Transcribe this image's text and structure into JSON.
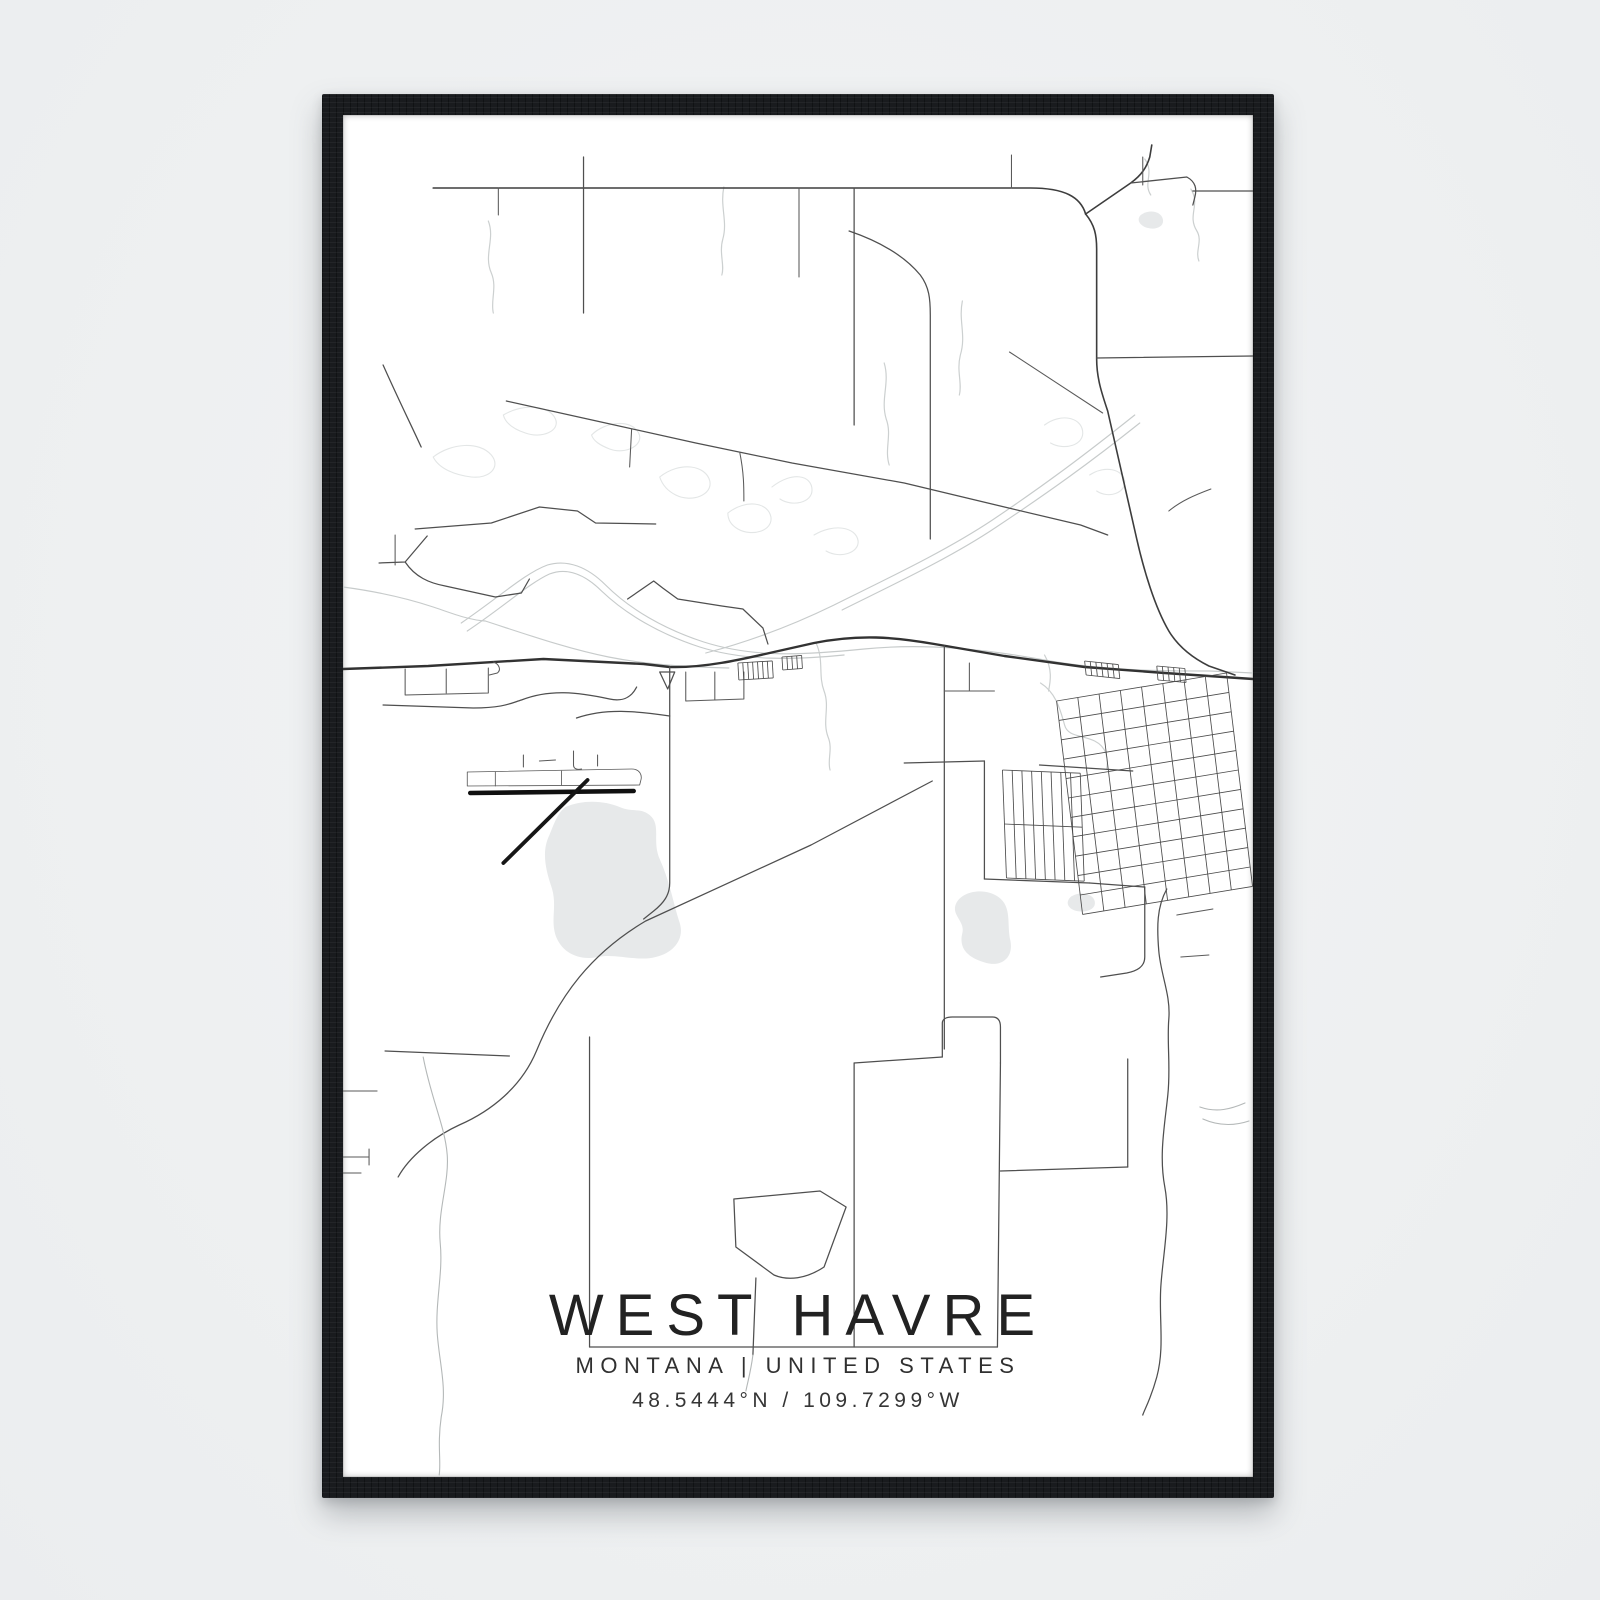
{
  "poster": {
    "title": "WEST HAVRE",
    "subtitle": "MONTANA | UNITED STATES",
    "coordinates": "48.5444°N / 109.7299°W"
  },
  "frame": {
    "color": "#191b1e",
    "background": "#eef0f1",
    "poster_color": "#ffffff"
  },
  "map": {
    "viewbox": "0 0 908 1362",
    "colors": {
      "road": "#4f4f4f",
      "major_road": "#323232",
      "highway": "#3d3d3d",
      "stream": "#ccd0d0",
      "meander": "#e3e6e6",
      "railway": "#c7cbcb",
      "water": "#e7e9ea",
      "runway": "#101010"
    },
    "features": [
      {
        "name": "lake-big",
        "type": "water",
        "d": "M 222,692 C 240,684 262,686 276,692 C 290,698 296,692 306,700 C 318,710 308,726 316,744 C 326,766 330,790 336,808 C 341,824 330,838 312,842 C 294,847 272,838 254,842 C 236,846 218,838 212,820 C 207,804 214,790 208,772 C 202,754 198,736 206,720 C 211,708 214,698 222,692 Z"
      },
      {
        "name": "pond-city",
        "type": "water",
        "d": "M 612,788 C 618,776 640,772 654,782 C 668,792 662,810 666,826 C 669,842 658,852 642,848 C 624,843 614,834 618,818 C 621,806 606,800 612,788 Z"
      },
      {
        "name": "pond-small",
        "type": "water",
        "d": "M 726,782 C 734,776 748,778 750,786 C 752,794 742,798 732,796 C 724,794 720,788 726,782 Z"
      },
      {
        "name": "pond-topright",
        "type": "water",
        "d": "M 796,100 C 804,94 816,96 818,104 C 820,112 810,116 800,112 C 794,109 792,104 796,100 Z"
      },
      {
        "name": "oxbow-1",
        "type": "meander",
        "d": "M 90,342 C 108,328 136,326 148,340 C 158,352 146,364 128,362 C 112,360 96,354 90,342"
      },
      {
        "name": "oxbow-2",
        "type": "meander",
        "d": "M 160,300 C 180,288 206,290 212,304 C 217,316 198,324 182,318 C 170,314 162,308 160,300"
      },
      {
        "name": "oxbow-3",
        "type": "meander",
        "d": "M 248,320 C 262,306 288,304 295,318 C 301,330 282,340 266,334 C 256,330 250,326 248,320"
      },
      {
        "name": "oxbow-4",
        "type": "meander",
        "d": "M 316,362 C 336,346 362,350 366,366 C 369,380 348,388 332,380 C 322,375 318,368 316,362"
      },
      {
        "name": "oxbow-5",
        "type": "meander",
        "d": "M 384,398 C 402,384 424,387 427,402 C 429,416 408,422 394,414 C 387,410 384,404 384,398"
      },
      {
        "name": "oxbow-6",
        "type": "meander",
        "d": "M 428,372 C 448,356 468,360 468,375 C 468,388 448,392 436,384"
      },
      {
        "name": "oxbow-7",
        "type": "meander",
        "d": "M 470,420 C 490,408 512,412 514,426 C 515,438 496,444 482,436"
      },
      {
        "name": "oxbow-8",
        "type": "meander",
        "d": "M 700,310 C 716,298 736,302 738,316 C 740,330 720,336 706,328"
      },
      {
        "name": "oxbow-9",
        "type": "meander",
        "d": "M 745,360 C 760,350 778,354 780,366 C 781,378 764,384 752,376"
      },
      {
        "name": "stream-1",
        "type": "stream",
        "d": "M 145,106 C 152,124 140,140 148,158 C 154,172 147,186 150,198"
      },
      {
        "name": "stream-2",
        "type": "stream",
        "d": "M 380,72 C 376,92 384,106 379,124 C 375,138 381,150 378,160"
      },
      {
        "name": "stream-3",
        "type": "stream",
        "d": "M 618,186 C 614,206 622,220 616,240 C 612,256 618,268 615,280"
      },
      {
        "name": "stream-4",
        "type": "stream",
        "d": "M 800,44 C 810,58 798,68 806,80"
      },
      {
        "name": "stream-5",
        "type": "stream",
        "d": "M 846,74 C 856,90 842,100 852,116 C 858,126 850,136 854,146"
      },
      {
        "name": "stream-6",
        "type": "stream",
        "d": "M 540,248 C 546,268 536,284 542,304 C 548,320 540,334 545,350"
      },
      {
        "name": "creek-below-road",
        "type": "stream",
        "d": "M 472,528 C 480,545 474,560 480,576 C 486,592 478,606 484,622 C 489,634 483,645 486,655"
      },
      {
        "name": "creek-town",
        "type": "stream",
        "d": "M 696,568 C 712,578 716,596 720,610 C 723,622 738,620 750,626 C 762,632 764,644 762,654"
      },
      {
        "name": "creek-town-2",
        "type": "stream",
        "d": "M 700,540 C 708,554 706,566 704,576"
      },
      {
        "name": "river-left",
        "type": "rail",
        "d": "M 0,472 C 30,476 60,482 90,492 C 108,498 125,505 142,506 C 185,520 225,534 265,542 C 305,550 345,552 385,553"
      },
      {
        "name": "railway-hump",
        "type": "rail",
        "d": "M 118,508 C 156,482 182,458 204,450 C 224,444 244,452 262,470 C 286,494 320,514 360,527 C 410,543 460,540 520,534 C 580,528 640,534 700,545 C 760,556 820,556 865,556 L 908,558"
      },
      {
        "name": "railway-hump-2",
        "type": "rail",
        "d": "M 124,516 C 160,492 186,468 206,459 C 224,452 242,460 258,476 C 282,499 316,519 356,532 C 400,546 450,545 500,540"
      },
      {
        "name": "rail-diagonal-ne",
        "type": "rail",
        "d": "M 790,300 C 740,340 700,370 648,405 C 600,437 540,465 490,490 C 445,512 400,528 362,538"
      },
      {
        "name": "rail-diagonal-ne-2",
        "type": "rail",
        "d": "M 795,308 C 745,348 703,378 652,412 C 606,443 548,470 498,495"
      },
      {
        "name": "road-top-horizontal",
        "type": "road-dk",
        "d": "M 90,73 L 686,73 C 720,73 736,82 741,99"
      },
      {
        "name": "highway-right",
        "type": "road-dk",
        "d": "M 741,99 C 750,110 752,120 752,134 L 752,244 C 752,263 757,278 763,296 L 792,424 C 799,455 810,492 824,516 C 833,531 848,543 864,551 L 890,560"
      },
      {
        "name": "highway-branch-ne",
        "type": "road-dk",
        "d": "M 741,99 L 786,68 C 797,60 802,52 805,42 L 807,30"
      },
      {
        "name": "road-topright-jog",
        "type": "road",
        "d": "M 786,68 L 842,62 C 851,67 852,74 850,82 L 848,90"
      },
      {
        "name": "road-topright-h",
        "type": "road",
        "d": "M 848,76 L 908,76"
      },
      {
        "name": "road-v-240",
        "type": "road",
        "d": "M 240,42 L 240,198"
      },
      {
        "name": "road-v-155",
        "type": "road-md",
        "d": "M 155,73 L 155,100"
      },
      {
        "name": "road-v-455",
        "type": "road-md",
        "d": "M 455,73 L 455,162"
      },
      {
        "name": "road-v-510",
        "type": "road",
        "d": "M 510,73 L 510,310"
      },
      {
        "name": "road-v-667",
        "type": "road-md",
        "d": "M 667,40 L 667,73"
      },
      {
        "name": "road-v-798",
        "type": "road-md",
        "d": "M 798,42 L 798,70"
      },
      {
        "name": "road-center-vertical",
        "type": "road",
        "d": "M 505,116 C 540,128 562,143 576,160 C 585,172 586,184 586,200 L 586,424"
      },
      {
        "name": "road-left-curve",
        "type": "road",
        "d": "M 40,250 C 56,286 68,310 78,332"
      },
      {
        "name": "road-long-diagonal",
        "type": "road",
        "d": "M 163,286 L 262,308 L 352,328 L 448,348 L 560,368 L 660,392 L 736,410 L 763,420"
      },
      {
        "name": "road-diag-stub-1",
        "type": "road-md",
        "d": "M 288,314 L 286,352"
      },
      {
        "name": "road-diag-stub-2",
        "type": "road-md",
        "d": "M 396,338 C 400,358 400,372 400,386"
      },
      {
        "name": "road-mid-right-h",
        "type": "road",
        "d": "M 752,243 L 908,241"
      },
      {
        "name": "road-mid-right-diag",
        "type": "road-md",
        "d": "M 665,237 L 758,298"
      },
      {
        "name": "road-right-diag-low",
        "type": "road-md",
        "d": "M 824,396 C 836,386 850,380 866,374"
      },
      {
        "name": "road-zigzag-a",
        "type": "road",
        "d": "M 72,414 L 148,408 L 196,392 L 234,396 L 252,408 L 312,409"
      },
      {
        "name": "road-fork-up",
        "type": "road",
        "d": "M 36,448 L 62,447 L 84,421"
      },
      {
        "name": "road-fork-down",
        "type": "road",
        "d": "M 62,447 C 72,462 86,468 102,471 L 152,482 L 178,478 L 186,464"
      },
      {
        "name": "road-tick-left",
        "type": "road-md",
        "d": "M 52,420 L 52,450"
      },
      {
        "name": "road-zigzag-b",
        "type": "road",
        "d": "M 284,484 L 310,466 L 319,473 L 334,484 L 378,491 L 399,494 L 419,513 L 424,529"
      },
      {
        "name": "main-road",
        "type": "major",
        "d": "M 0,554 L 85,551 L 200,544 L 300,549 L 326,552 C 360,553 395,545 430,537 L 470,528 C 515,519 550,522 590,529 L 660,541 L 740,552 L 820,558 L 908,564"
      },
      {
        "name": "road-vertical-junction",
        "type": "road",
        "d": "M 326,552 L 326,768 C 326,780 320,788 310,796 L 300,804"
      },
      {
        "name": "road-vertical-600",
        "type": "road",
        "d": "M 600,531 L 600,934"
      },
      {
        "name": "road-sw-diagonal",
        "type": "road",
        "d": "M 588,666 L 467,730 L 302,806 C 248,838 216,880 193,936 C 178,972 148,996 116,1010 C 90,1022 66,1042 55,1062"
      },
      {
        "name": "road-left-wavy-down",
        "type": "faint",
        "d": "M 80,942 C 88,984 102,1012 104,1040 C 106,1068 94,1096 97,1128 C 100,1158 92,1186 94,1218 C 96,1248 104,1272 98,1302 C 94,1330 98,1346 96,1360"
      },
      {
        "name": "road-bl-horizontal",
        "type": "road",
        "d": "M 42,936 L 166,941"
      },
      {
        "name": "stub-left-1",
        "type": "road-md",
        "d": "M 0,976 L 34,976"
      },
      {
        "name": "stub-left-2",
        "type": "road-md",
        "d": "M 0,1042 L 26,1042"
      },
      {
        "name": "stub-left-3",
        "type": "road-md",
        "d": "M 26,1034 L 26,1050"
      },
      {
        "name": "stub-left-4",
        "type": "road-md",
        "d": "M 0,1058 L 18,1058"
      },
      {
        "name": "rect-top",
        "type": "road",
        "d": "M 510,948 L 598,942"
      },
      {
        "name": "rect-notch",
        "type": "road",
        "d": "M 598,942 L 598,908 C 598,904 602,902 608,902 L 648,902 C 654,902 656,906 656,912 L 656,948"
      },
      {
        "name": "rect-right",
        "type": "road",
        "d": "M 656,948 L 653,1232"
      },
      {
        "name": "rect-left",
        "type": "road",
        "d": "M 510,948 L 510,1232"
      },
      {
        "name": "road-bottom-horizontal",
        "type": "road",
        "d": "M 246,1232 L 653,1232"
      },
      {
        "name": "road-vertical-246",
        "type": "road",
        "d": "M 246,922 L 246,1232"
      },
      {
        "name": "pentagon",
        "type": "road",
        "d": "M 390,1084 L 476,1076 L 502,1092 L 480,1152 C 462,1164 444,1166 430,1160 L 392,1132 Z"
      },
      {
        "name": "pentagon-stem",
        "type": "road",
        "d": "M 412,1163 L 409,1240"
      },
      {
        "name": "pentagon-stem-tail",
        "type": "faint",
        "d": "M 409,1240 C 407,1256 404,1266 402,1276"
      },
      {
        "name": "blocks-right-h",
        "type": "road",
        "d": "M 656,1056 L 783,1052"
      },
      {
        "name": "blocks-right-v",
        "type": "road",
        "d": "M 783,944 L 783,1052"
      },
      {
        "name": "airport-access",
        "type": "road",
        "d": "M 40,590 L 130,593 C 160,593 168,588 178,585 C 206,574 234,577 266,584 C 280,587 288,582 293,572"
      },
      {
        "name": "runway-outline",
        "type": "outline",
        "d": "M 124,657 L 288,654 C 296,654 299,660 297,666 L 296,670 L 124,671 Z"
      },
      {
        "name": "runway-tick-1",
        "type": "outline",
        "d": "M 152,657 L 152,671"
      },
      {
        "name": "runway-tick-2",
        "type": "outline",
        "d": "M 218,656 L 218,670"
      },
      {
        "name": "apron-mark-1",
        "type": "road-md",
        "d": "M 180,640 L 180,652"
      },
      {
        "name": "apron-mark-2",
        "type": "road-md",
        "d": "M 196,646 L 212,645"
      },
      {
        "name": "apron-mark-3",
        "type": "road-md",
        "d": "M 230,636 L 230,650 C 230,654 234,655 238,654"
      },
      {
        "name": "apron-mark-4",
        "type": "road-md",
        "d": "M 254,640 L 254,651"
      },
      {
        "name": "runway-main",
        "type": "runway",
        "d": "M 127,678 L 290,676"
      },
      {
        "name": "runway-cross",
        "type": "runway2",
        "d": "M 244,665 L 160,748"
      },
      {
        "name": "road-below-airport",
        "type": "road",
        "d": "M 233,603 C 262,593 292,596 326,601"
      },
      {
        "name": "junction-wedge",
        "type": "road",
        "d": "M 316,557 L 331,557 L 324,574 Z"
      },
      {
        "name": "box-left-main",
        "type": "road-md",
        "d": "M 62,554 L 62,580 L 145,578 L 145,553"
      },
      {
        "name": "box-left-divider",
        "type": "road-md",
        "d": "M 103,554 L 103,578"
      },
      {
        "name": "hook-main",
        "type": "road-md",
        "d": "M 150,547 C 156,549 158,555 154,558 L 146,560"
      },
      {
        "name": "box-right-junction",
        "type": "road-md",
        "d": "M 342,557 L 342,586 L 400,584 L 400,557"
      },
      {
        "name": "box-right-divider",
        "type": "road-md",
        "d": "M 371,557 L 371,585"
      },
      {
        "name": "stub-600-h",
        "type": "road-md",
        "d": "M 600,576 L 650,576"
      },
      {
        "name": "stub-625-v",
        "type": "road-md",
        "d": "M 625,548 L 625,576"
      },
      {
        "name": "street-648",
        "type": "road",
        "d": "M 560,648 L 640,646"
      },
      {
        "name": "street-640-v",
        "type": "road",
        "d": "M 640,646 L 640,764"
      },
      {
        "name": "street-764-h",
        "type": "road",
        "d": "M 640,764 L 745,768"
      },
      {
        "name": "street-650-h",
        "type": "road",
        "d": "M 695,650 L 788,656"
      },
      {
        "name": "street-768-ext",
        "type": "road",
        "d": "M 745,768 L 800,772"
      },
      {
        "name": "street-800-v",
        "type": "road",
        "d": "M 800,772 L 800,842 C 800,852 792,856 782,858 L 756,862"
      },
      {
        "name": "street-832",
        "type": "road-md",
        "d": "M 832,800 L 868,794"
      },
      {
        "name": "street-836",
        "type": "road-md",
        "d": "M 836,842 L 864,840"
      },
      {
        "name": "road-right-edge-down",
        "type": "road",
        "d": "M 822,774 C 812,792 812,812 814,836 C 816,860 826,880 824,904 C 822,928 826,952 823,980 C 820,1010 814,1040 820,1072 C 826,1104 818,1140 816,1172 C 814,1204 820,1232 812,1262 C 806,1284 800,1294 798,1300"
      },
      {
        "name": "branch-right-1",
        "type": "faint",
        "d": "M 855,992 C 872,998 886,994 900,988"
      },
      {
        "name": "branch-right-2",
        "type": "faint",
        "d": "M 858,1004 C 876,1012 892,1010 904,1006"
      }
    ],
    "lattices": [
      {
        "name": "city-grid",
        "origin": [
          712,
          586
        ],
        "axis1": [
          21.2,
          -3.5
        ],
        "n1": 9,
        "axis2": [
          2.36,
          19.4
        ],
        "n2": 12
      },
      {
        "name": "comb-rail-a",
        "origin": [
          740,
          546
        ],
        "axis1": [
          5.6,
          0.6
        ],
        "n1": 7,
        "axis2": [
          1.5,
          14
        ],
        "n2": 2
      },
      {
        "name": "comb-rail-b",
        "origin": [
          812,
          551
        ],
        "axis1": [
          5.6,
          0.5
        ],
        "n1": 6,
        "axis2": [
          1.2,
          14
        ],
        "n2": 2
      },
      {
        "name": "comb-main-c",
        "origin": [
          394,
          548
        ],
        "axis1": [
          4.9,
          -0.3
        ],
        "n1": 8,
        "axis2": [
          1,
          17
        ],
        "n2": 2
      },
      {
        "name": "comb-main-d",
        "origin": [
          438,
          542
        ],
        "axis1": [
          4.9,
          -0.4
        ],
        "n1": 5,
        "axis2": [
          0.8,
          13
        ],
        "n2": 2
      },
      {
        "name": "town-subgrid",
        "origin": [
          658,
          655
        ],
        "axis1": [
          9.7,
          0.4
        ],
        "n1": 9,
        "axis2": [
          2,
          54
        ],
        "n2": 3
      }
    ]
  }
}
